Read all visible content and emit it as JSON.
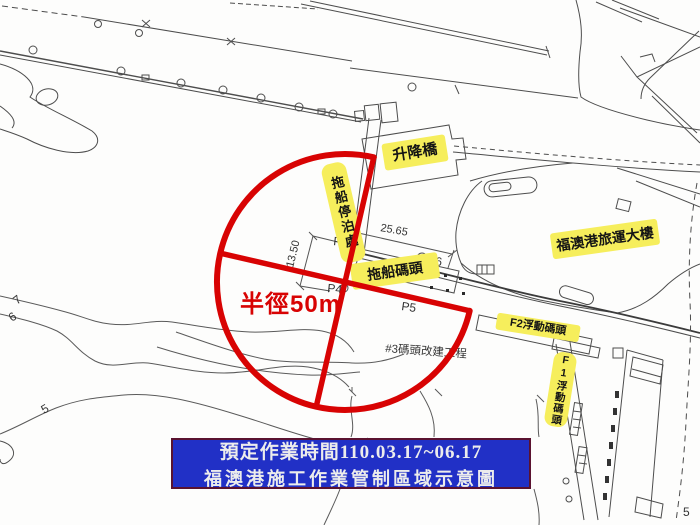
{
  "banner": {
    "line1": "預定作業時間110.03.17~06.17",
    "line2": "福澳港施工作業管制區域示意圖"
  },
  "annotations": {
    "radius": "半徑50m",
    "project": "#3碼頭改建工程",
    "dim_length": "25.65",
    "dim_width": "13.50"
  },
  "site_labels": {
    "lift_bridge": "升降橋",
    "tug_mooring": "拖船停泊處",
    "tug_wharf": "拖船碼頭",
    "terminal": "福澳港旅運大樓",
    "f2_pier": "F2浮動碼頭",
    "f1_pier": "F1浮動碼頭"
  },
  "survey_points": {
    "p3": "P3",
    "p4": "P4",
    "p5": "P5",
    "p6": "P6"
  },
  "contours": {
    "c7": "7",
    "c6": "6",
    "c5": "5",
    "c5r": "5"
  },
  "colors": {
    "restricted_zone_red": "#d80303",
    "label_yellow": "#f6ee5c",
    "banner_blue": "#2130c6",
    "banner_border": "#5a1230",
    "map_line_gray": "#4d4d4d"
  }
}
